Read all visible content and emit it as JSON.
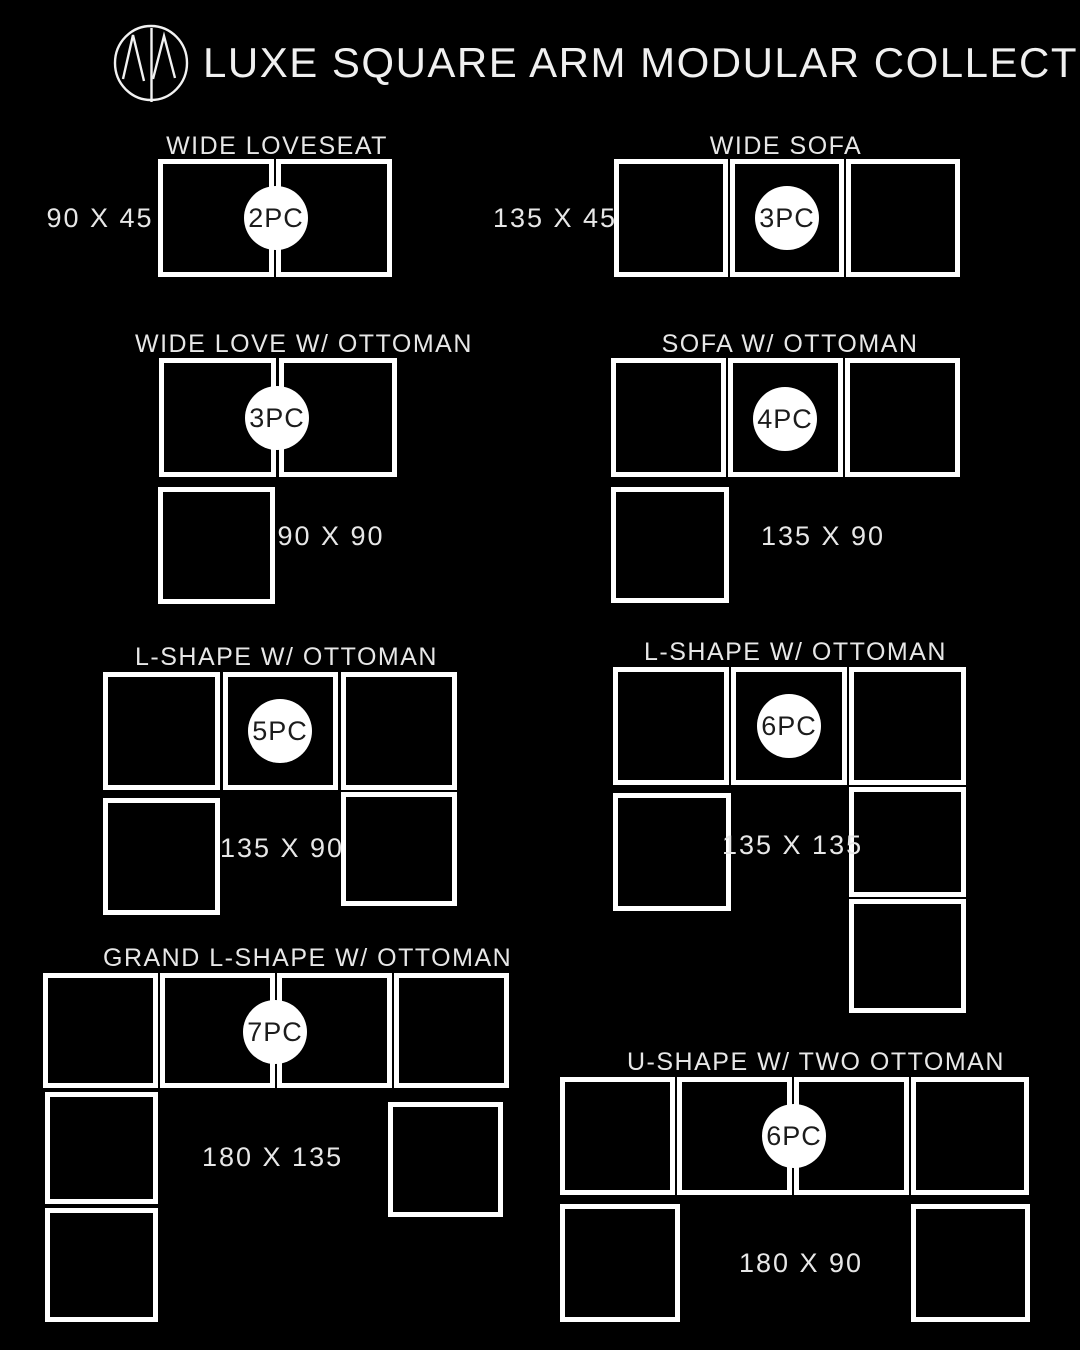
{
  "header": {
    "logo": "nm-monogram-logo",
    "title": "LUXE SQUARE ARM MODULAR COLLECTION"
  },
  "colors": {
    "background": "#000000",
    "outline": "#ffffff",
    "label_text": "#e7e7e7",
    "badge_fill": "#ffffff",
    "badge_text": "#1c1c1c"
  },
  "configurations": [
    {
      "title": "WIDE LOVESEAT",
      "pieces": "2PC",
      "dimensions": "90 X 45"
    },
    {
      "title": "WIDE SOFA",
      "pieces": "3PC",
      "dimensions": "135 X 45"
    },
    {
      "title": "WIDE LOVE W/ OTTOMAN",
      "pieces": "3PC",
      "dimensions": "90 X 90"
    },
    {
      "title": "SOFA W/ OTTOMAN",
      "pieces": "4PC",
      "dimensions": "135 X 90"
    },
    {
      "title": "L-SHAPE W/ OTTOMAN",
      "pieces": "5PC",
      "dimensions": "135 X 90"
    },
    {
      "title": "L-SHAPE W/ OTTOMAN",
      "pieces": "6PC",
      "dimensions": "135 X 135"
    },
    {
      "title": "GRAND L-SHAPE W/ OTTOMAN",
      "pieces": "7PC",
      "dimensions": "180 X 135"
    },
    {
      "title": "U-SHAPE W/ TWO OTTOMAN",
      "pieces": "6PC",
      "dimensions": "180 X 90"
    }
  ]
}
